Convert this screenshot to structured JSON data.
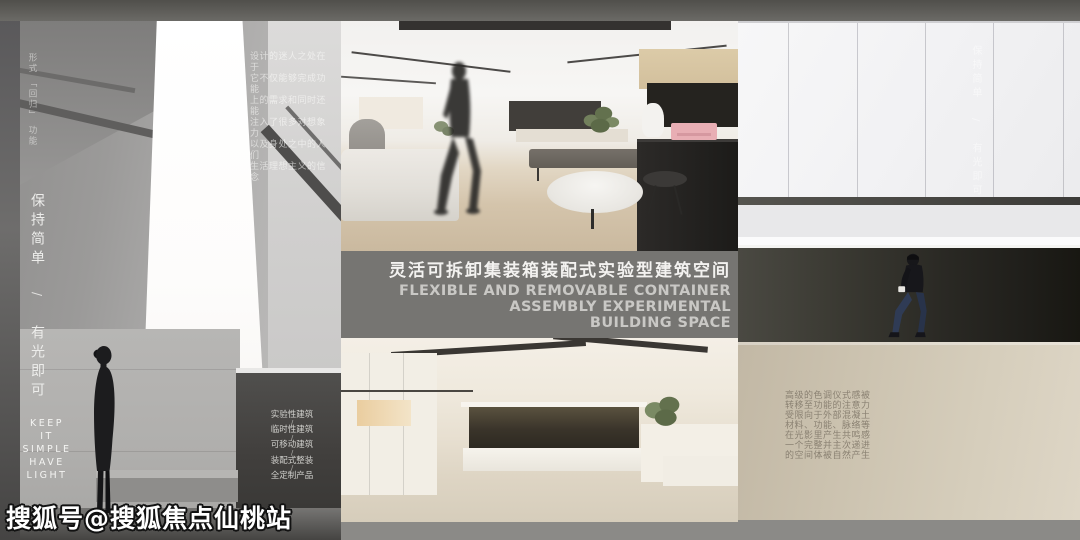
{
  "watermark": {
    "text": "搜狐号@搜狐焦点仙桃站"
  },
  "left_panel": {
    "side_label": "形式 「回归」 功能",
    "intro_lines": [
      "设计的迷人之处在于",
      "它不仅能够完成功能",
      "上的需求和同时还能",
      "注入了很多对想象力",
      "以及身处之中的人们",
      "生活理想主义的信念"
    ],
    "slogan_zh_1": "保持简单",
    "slogan_divider": "/",
    "slogan_zh_2": "有光即可",
    "slogan_en_lines": [
      "KEEP",
      "IT",
      "SIMPLE",
      "HAVE",
      "LIGHT"
    ],
    "category_divider": "/",
    "categories": [
      "实验性建筑",
      "临时性建筑",
      "可移动建筑",
      "装配式整装",
      "全定制产品"
    ]
  },
  "center_banner": {
    "title_zh": "灵活可拆卸集装箱装配式实验型建筑空间",
    "title_en_lines": [
      "FLEXIBLE AND REMOVABLE CONTAINER",
      "ASSEMBLY EXPERIMENTAL",
      "BUILDING SPACE"
    ]
  },
  "right_panel": {
    "faint_slogan_1": "保持简单",
    "faint_divider": "/",
    "faint_slogan_2": "有光即可",
    "description_lines": [
      "高级的色调仪式感被",
      "转移至功能的注意力",
      "受限向于外部混凝土",
      "材料、功能、脉络等",
      "在光影里产生共鸣感",
      "一个完整并主次递进",
      "的空间体被自然产生"
    ]
  },
  "colors": {
    "canvas_bg": "#7b7a77",
    "title_band_bg": "#767572",
    "charcoal_walkway": "#2a2924",
    "beige_wall": "#cfc6b4",
    "title_zh_color": "#f3f2f0",
    "title_en_color": "#c9c8c5"
  }
}
